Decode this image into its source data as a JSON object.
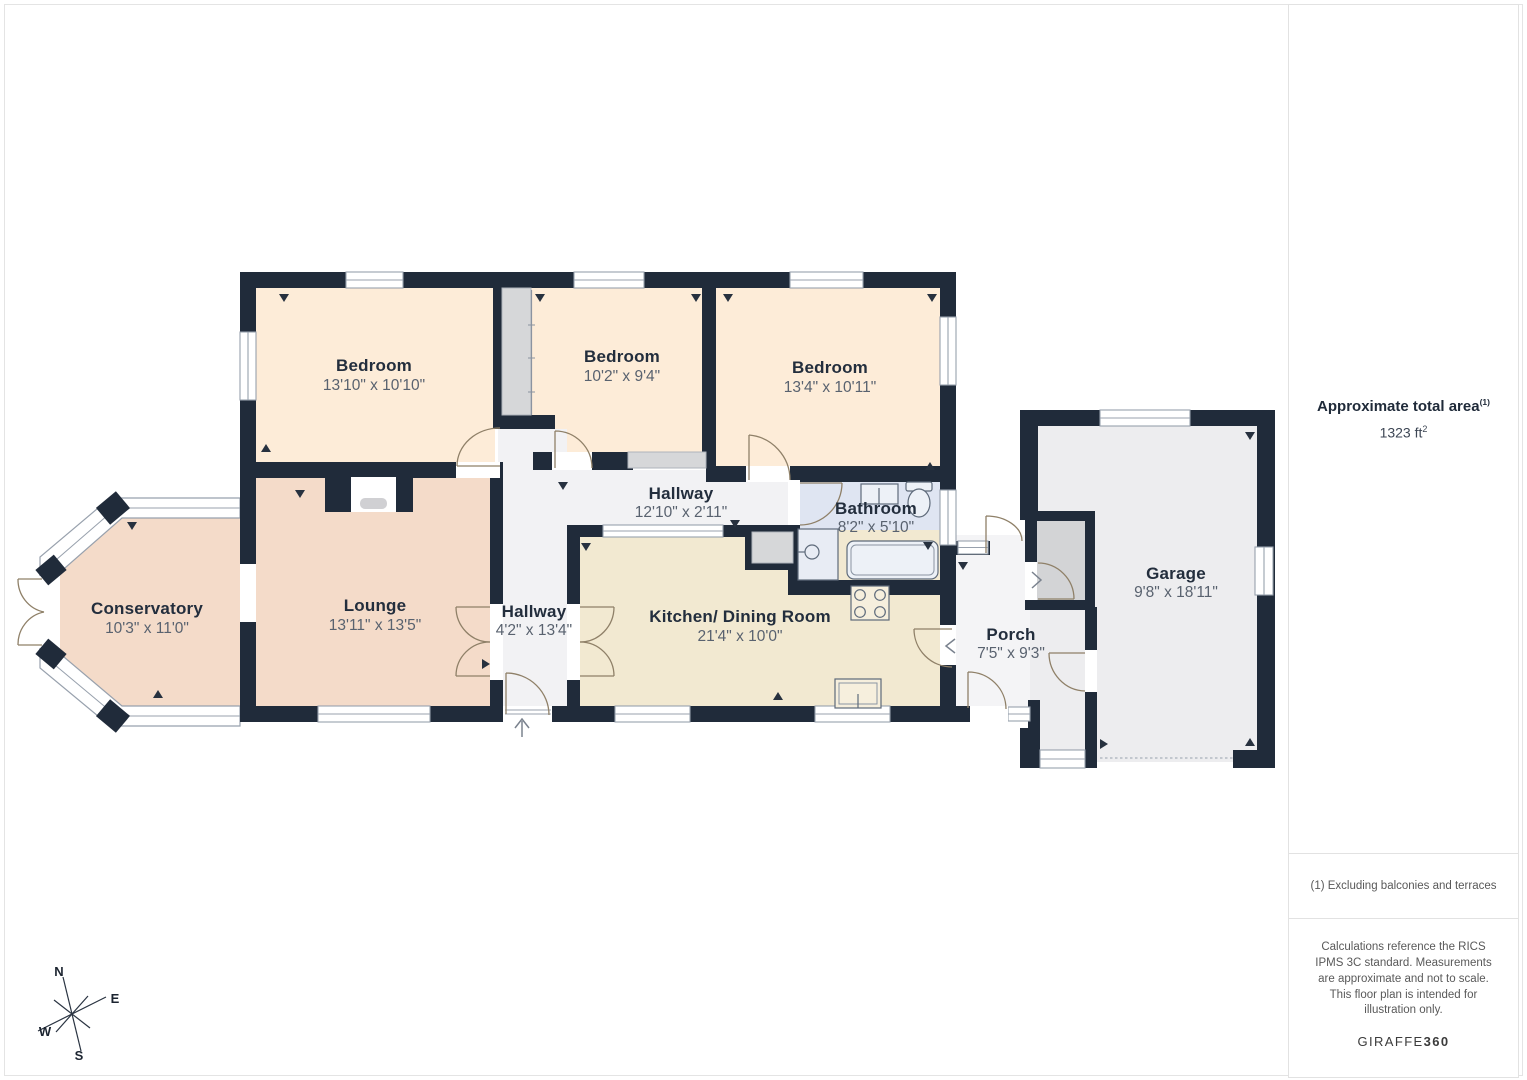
{
  "plan": {
    "rooms": [
      {
        "id": "bedroom-1",
        "name": "Bedroom",
        "dims": "13'10\" x 10'10\""
      },
      {
        "id": "bedroom-2",
        "name": "Bedroom",
        "dims": "10'2\" x 9'4\""
      },
      {
        "id": "bedroom-3",
        "name": "Bedroom",
        "dims": "13'4\" x 10'11\""
      },
      {
        "id": "hallway-top",
        "name": "Hallway",
        "dims": "12'10\" x 2'11\""
      },
      {
        "id": "bathroom",
        "name": "Bathroom",
        "dims": "8'2\" x 5'10\""
      },
      {
        "id": "conservatory",
        "name": "Conservatory",
        "dims": "10'3\" x 11'0\""
      },
      {
        "id": "lounge",
        "name": "Lounge",
        "dims": "13'11\" x 13'5\""
      },
      {
        "id": "hallway-main",
        "name": "Hallway",
        "dims": "4'2\" x 13'4\""
      },
      {
        "id": "kitchen-dining",
        "name": "Kitchen/ Dining Room",
        "dims": "21'4\" x 10'0\""
      },
      {
        "id": "porch",
        "name": "Porch",
        "dims": "7'5\" x 9'3\""
      },
      {
        "id": "garage",
        "name": "Garage",
        "dims": "9'8\" x 18'11\""
      }
    ],
    "compass": {
      "n": "N",
      "e": "E",
      "s": "S",
      "w": "W"
    }
  },
  "sidebar": {
    "area_label": "Approximate total area",
    "area_sup": "(1)",
    "area_value": "1323 ft",
    "area_sup2": "2",
    "footnote": "(1) Excluding balconies and terraces",
    "disclaimer": "Calculations reference the RICS IPMS 3C standard. Measurements are approximate and not to scale. This floor plan is intended for illustration only.",
    "brand": "GIRAFFE",
    "brand_bold": "360"
  },
  "colors": {
    "wall": "#202b3a",
    "bedroom": "#fdecd8",
    "lounge": "#f4dbc9",
    "kitchen": "#f2e9d1",
    "bathroom": "#dfe5f2",
    "hall": "#f2f2f4",
    "garage": "#ededef",
    "closet": "#d6d7d9",
    "window_line": "#98a1ad",
    "door_arc": "#8f8068"
  }
}
